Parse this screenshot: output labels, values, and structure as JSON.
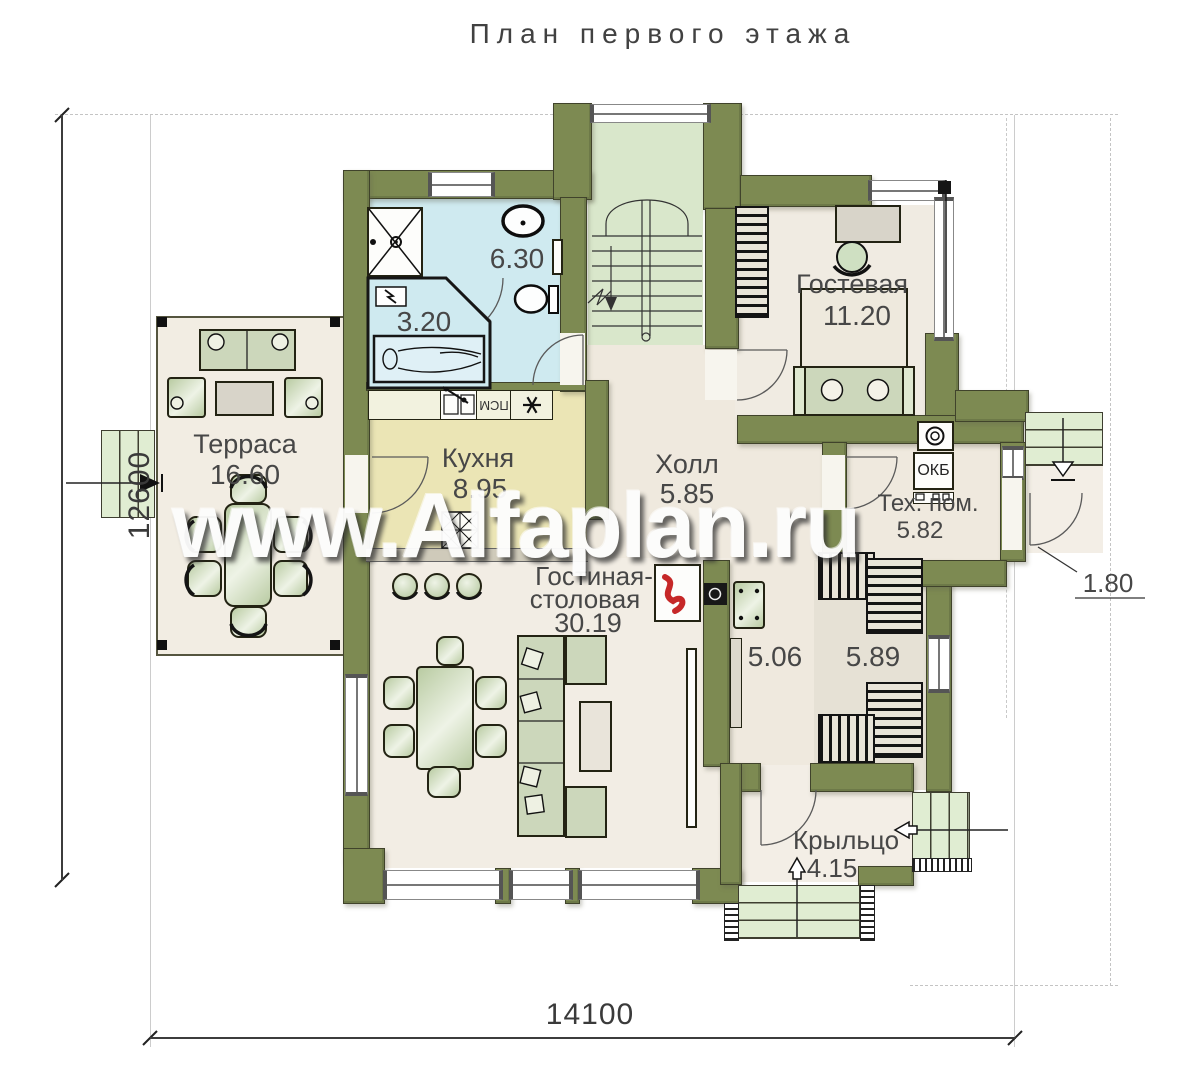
{
  "title": "План первого этажа",
  "watermark": "www.Alfaplan.ru",
  "dims": {
    "height": "12600",
    "width": "14100"
  },
  "rooms": {
    "terrace": {
      "name": "Терраса",
      "area": "16.60"
    },
    "kitchen": {
      "name": "Кухня",
      "area": "8.95"
    },
    "hall": {
      "name": "Холл",
      "area": "5.85"
    },
    "bathroom": {
      "area": "6.30"
    },
    "sauna": {
      "area": "3.20"
    },
    "guest": {
      "name": "Гостевая",
      "area": "11.20"
    },
    "tech": {
      "name": "Тех. пом.",
      "area": "5.82"
    },
    "living": {
      "name1": "Гостиная-",
      "name2": "столовая",
      "area": "30.19"
    },
    "corridor": {
      "area": "5.06"
    },
    "dressing": {
      "area": "5.89"
    },
    "porch": {
      "name": "Крыльцо",
      "area": "4.15"
    },
    "entry": {
      "area": "1.80"
    }
  },
  "equipment": {
    "boiler": "ОКБ",
    "dishwasher": "ПСМ"
  },
  "colors": {
    "wall": "#7d8a52",
    "bath": "#cfeaf0",
    "kitchen": "#ebe5b5",
    "stairs": "#d9e7cb",
    "floor": "#efe9de",
    "terrace": "#f2ede3",
    "flame": "#c62828"
  }
}
